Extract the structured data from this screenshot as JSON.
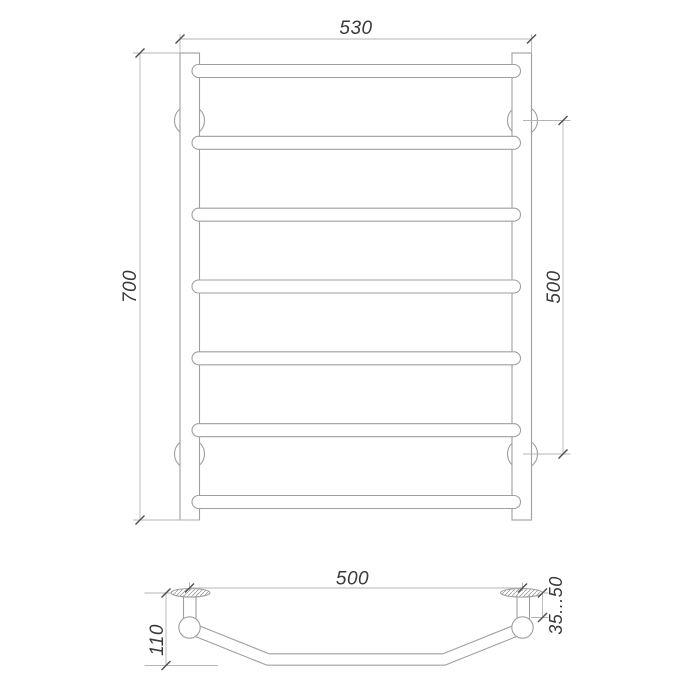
{
  "colors": {
    "background": "#ffffff",
    "object_line": "#9f9f9f",
    "dimension_line": "#b5b5b5",
    "tick": "#4f4f4f",
    "text": "#3a3a3a"
  },
  "front_view": {
    "overall_width_label": "530",
    "overall_height_label": "700",
    "mount_spacing_label": "500",
    "rail_count": 7,
    "bracket_count": 4
  },
  "top_view": {
    "mount_width_label": "500",
    "depth_label": "110",
    "wall_clearance_label": "35...50"
  }
}
